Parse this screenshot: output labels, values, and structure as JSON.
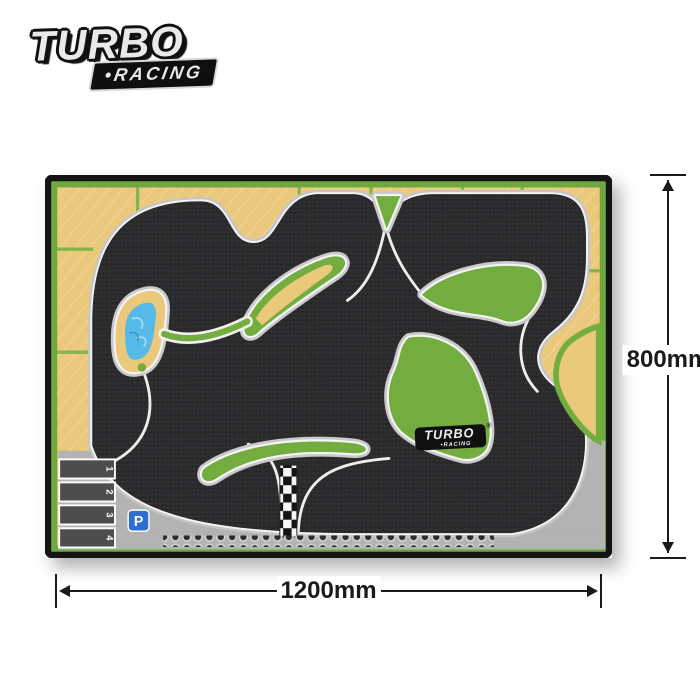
{
  "brand": {
    "primary": "TURBO",
    "secondary": "•RACING"
  },
  "mat": {
    "badge": {
      "primary": "TURBO",
      "secondary": "•RACING",
      "registered": "®"
    },
    "parking_sign": "P",
    "pit_slots": [
      "1",
      "2",
      "3",
      "4"
    ],
    "colors": {
      "asphalt": "#2b2b2d",
      "grass": "#74ad3f",
      "sand": "#eac87c",
      "pond": "#56b9e8",
      "curb_gray": "#c6c6c6",
      "line_white": "#f4f4f4",
      "apron_gray": "#b3b3b3",
      "border_green": "#6fa83e"
    }
  },
  "dimensions": {
    "height": "800mm",
    "width": "1200mm"
  }
}
